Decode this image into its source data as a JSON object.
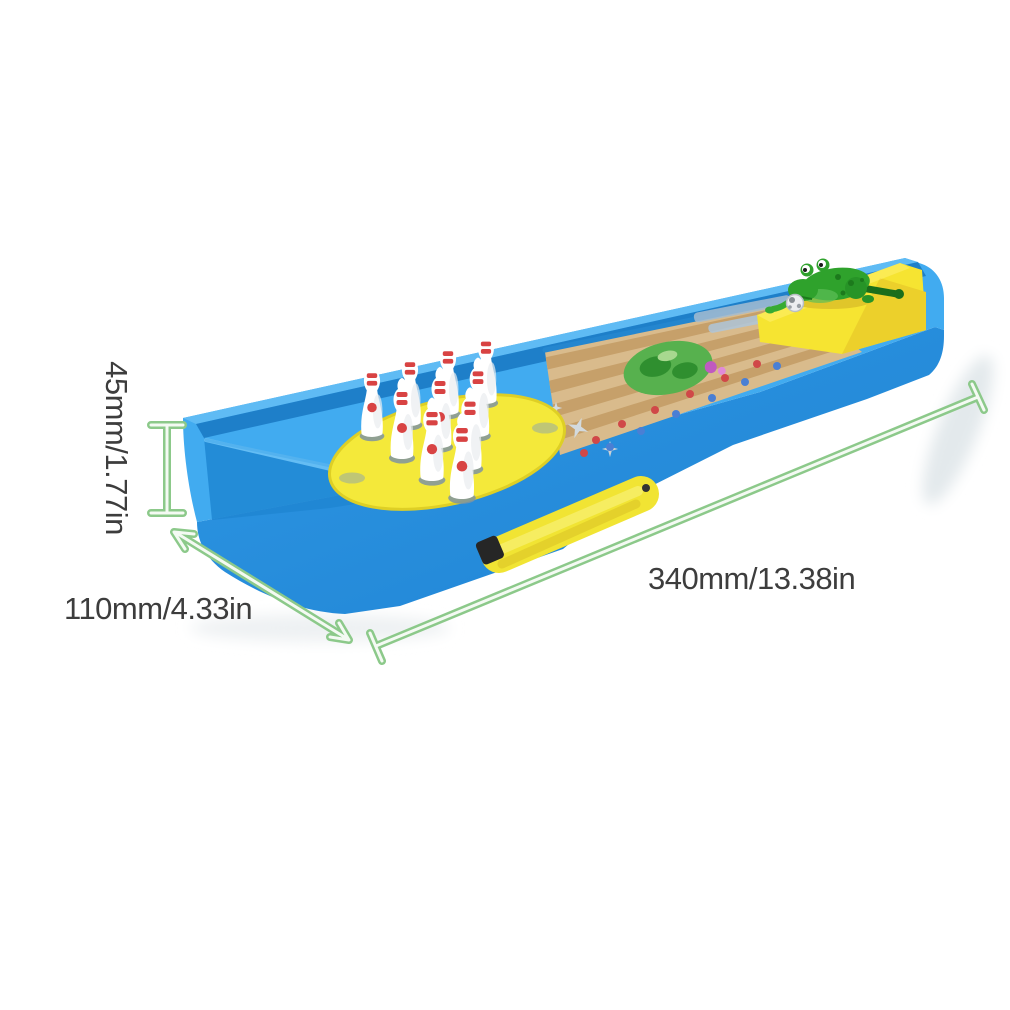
{
  "scene": {
    "subject": "mini tabletop frog bowling game toy on white background",
    "background_color": "#ffffff"
  },
  "annotations": {
    "height_label": "45mm/1.77in",
    "width_label": "110mm/4.33in",
    "length_label": "340mm/13.38in",
    "line_color": "#8cc98a",
    "text_color": "#3d3d3d"
  },
  "toy": {
    "base_front_color": "#2b93e0",
    "base_deck_color": "#41abf0",
    "rail_color": "#5fbbf4",
    "tray_color": "#1f86d2",
    "pin_platform_color": "#f4e93a",
    "lane_color": "#d9bb8c",
    "lane_stripe_color": "#c6a06a",
    "lane_frog_print_color": "#57b14e",
    "lane_dot_colors": {
      "red": "#d04848",
      "blue": "#4a7fd4"
    },
    "pin_count": 10,
    "pin_color": "#ffffff",
    "pin_stripe_color": "#d84343",
    "pin_hole_color": "#7e93a2",
    "frog_color": "#2fa22c",
    "frog_dark_color": "#1c7a1c",
    "ramp_color": "#f6e431",
    "slider_color": "#f1e433",
    "slider_cap_color": "#262626",
    "ball_color": "#eceef0"
  }
}
